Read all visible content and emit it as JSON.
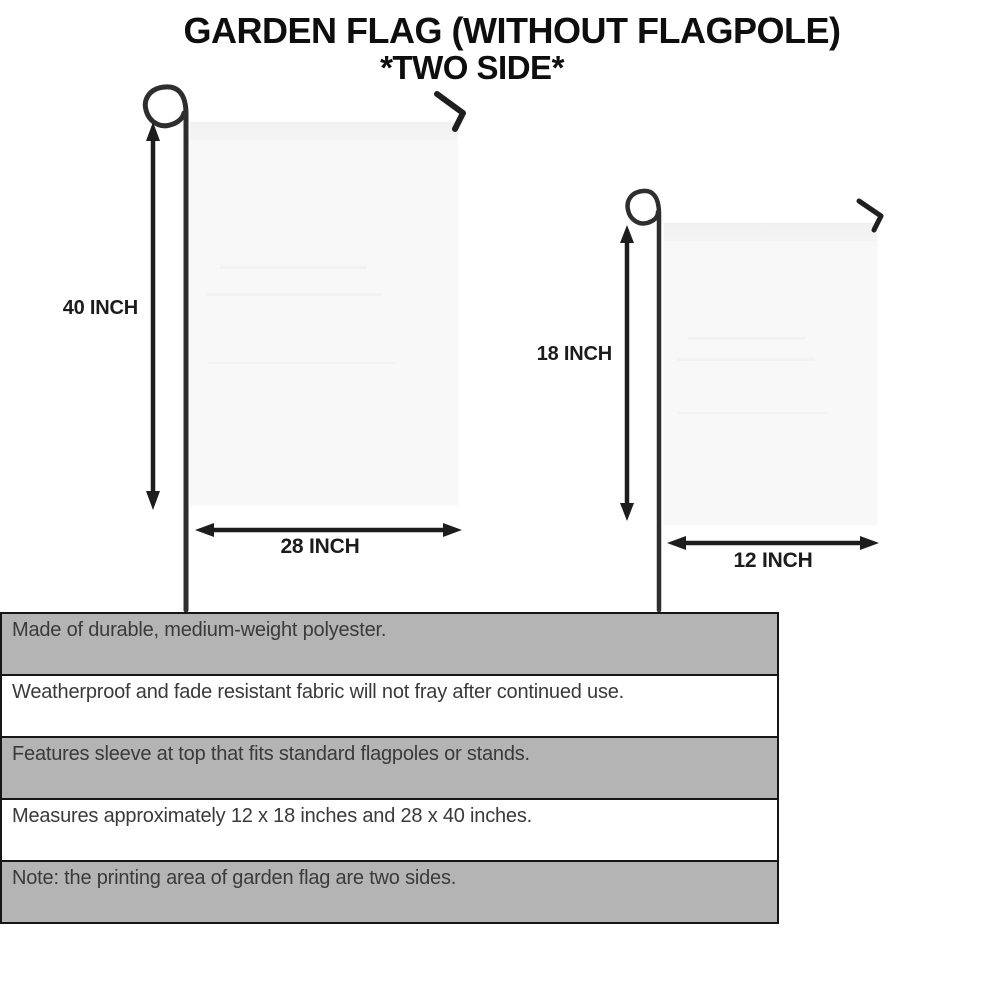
{
  "title": {
    "line1": "GARDEN FLAG (WITHOUT FLAGPOLE)",
    "line2": "*TWO SIDE*"
  },
  "diagram": {
    "large_flag": {
      "height_label": "40 INCH",
      "width_label": "28 INCH"
    },
    "small_flag": {
      "height_label": "18 INCH",
      "width_label": "12 INCH"
    }
  },
  "features": {
    "rows": [
      {
        "text": "Made of durable, medium-weight polyester.",
        "shaded": true
      },
      {
        "text": "Weatherproof and fade resistant fabric will not fray after continued use.",
        "shaded": false
      },
      {
        "text": "Features sleeve at top that fits standard flagpoles or stands.",
        "shaded": true
      },
      {
        "text": "Measures approximately 12 x 18 inches and 28 x 40 inches.",
        "shaded": false
      },
      {
        "text": "Note: the printing area of garden flag are two sides.",
        "shaded": true
      }
    ]
  },
  "colors": {
    "row_shaded": "#b4b4b4",
    "row_plain": "#ffffff",
    "table_border": "#161616",
    "flag_fill": "#f8f8f8",
    "pole": "#2e2e2e",
    "arrow": "#1d1d1d",
    "title_text": "#0e0e0e",
    "body_text": "#3a3a3a"
  }
}
